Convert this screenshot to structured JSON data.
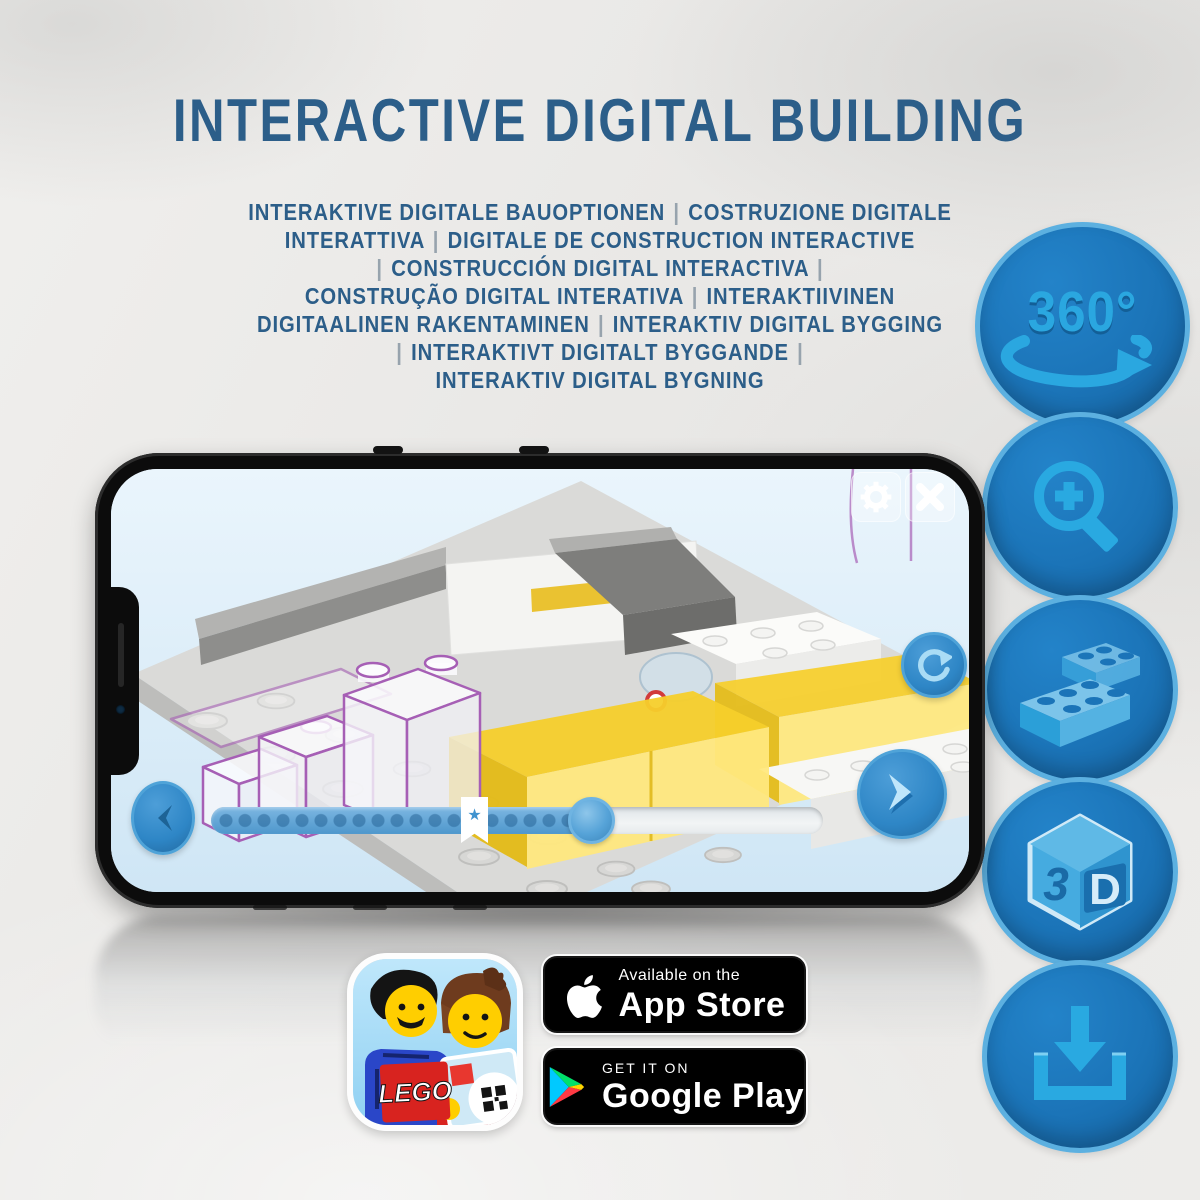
{
  "title": "INTERACTIVE DIGITAL BUILDING",
  "subtitle": {
    "lines": [
      "INTERAKTIVE DIGITALE BAUOPTIONEN | COSTRUZIONE DIGITALE",
      "INTERATTIVA | DIGITALE DE CONSTRUCTION INTERACTIVE",
      "| CONSTRUCCIÓN DIGITAL INTERACTIVA |",
      "CONSTRUÇÃO DIGITAL INTERATIVA | INTERAKTIIVINEN",
      "DIGITAALINEN RAKENTAMINEN | INTERAKTIV DIGITAL BYGGING",
      "| INTERAKTIVT DIGITALT BYGGANDE |",
      "INTERAKTIV DIGITAL BYGNING"
    ]
  },
  "feature_badges": [
    {
      "name": "360-view",
      "icon": "360-rotation-icon",
      "label": "360°"
    },
    {
      "name": "zoom-in",
      "icon": "zoom-in-icon"
    },
    {
      "name": "digital-bricks",
      "icon": "lego-brick-icon"
    },
    {
      "name": "3d-view",
      "icon": "3d-cube-icon",
      "label_3": "3",
      "label_d": "D"
    },
    {
      "name": "download",
      "icon": "download-icon"
    }
  ],
  "phone_app": {
    "icons": [
      "settings-gear-icon",
      "close-icon",
      "rotate-model-icon",
      "previous-step-icon",
      "next-step-icon",
      "bookmark-star-icon"
    ],
    "bookmark_star_glyph": "★",
    "progress": {
      "fill_percent": 62,
      "bookmark_percent": 43
    }
  },
  "app_icon": {
    "name": "lego-building-instructions-app-icon",
    "lego_logo_text": "LEGO",
    "qr": "qr-code-icon"
  },
  "store_badges": {
    "app_store": {
      "icon": "apple-logo-icon",
      "tagline": "Available on the",
      "name": "App Store"
    },
    "google_play": {
      "icon": "google-play-icon",
      "tagline": "GET IT ON",
      "name": "Google Play"
    }
  },
  "colors": {
    "title_blue": "#2c5e89",
    "badge_blue": "#1b74b8",
    "badge_icon_blue": "#29a9e1",
    "badge_rim_blue": "#5cb0e0",
    "app_accent_blue": "#2e86c6",
    "screen_sky": "#d9eaf7",
    "lego_yellow": "#f6cf2b",
    "ghost_outline_purple": "#a65fb5",
    "store_badge_black": "#000000",
    "lego_red": "#d01012",
    "play_cyan": "#00c9ff",
    "play_green": "#00e06a",
    "play_red": "#ff3a44",
    "play_yellow": "#ffd400"
  }
}
